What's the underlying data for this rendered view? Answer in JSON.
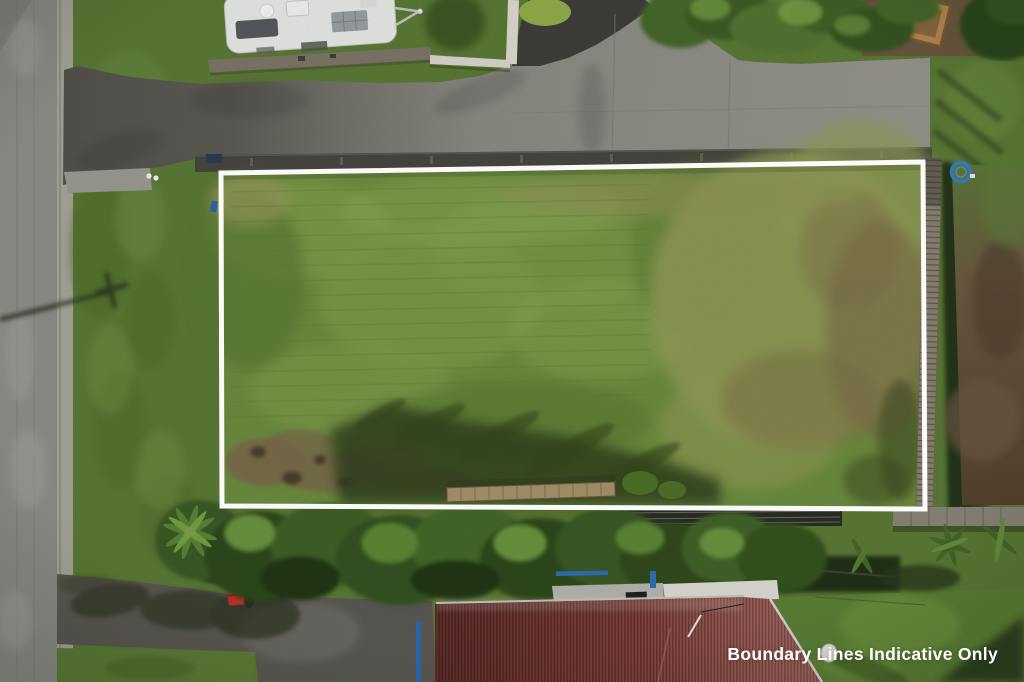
{
  "overlay": {
    "caption": "Boundary Lines Indicative Only",
    "caption_color": "#ffffff",
    "boundary_line_color": "#ffffff"
  },
  "palette": {
    "lot_grass": "#6d8c3f",
    "rough_grass": "#939b58",
    "berm_grass": "#5c7a36",
    "street_asphalt": "#8e8e8a",
    "driveway_asphalt": "#54534d",
    "concrete_driveway": "#90908a",
    "tree_canopy": "#3b5a25",
    "house_roof_red": "#8a453f",
    "bare_dirt": "#5d4a36",
    "caravan_body": "#e8eae8",
    "accent_blue": "#2f6fb5",
    "wheelie_bin_red": "#c23127"
  }
}
